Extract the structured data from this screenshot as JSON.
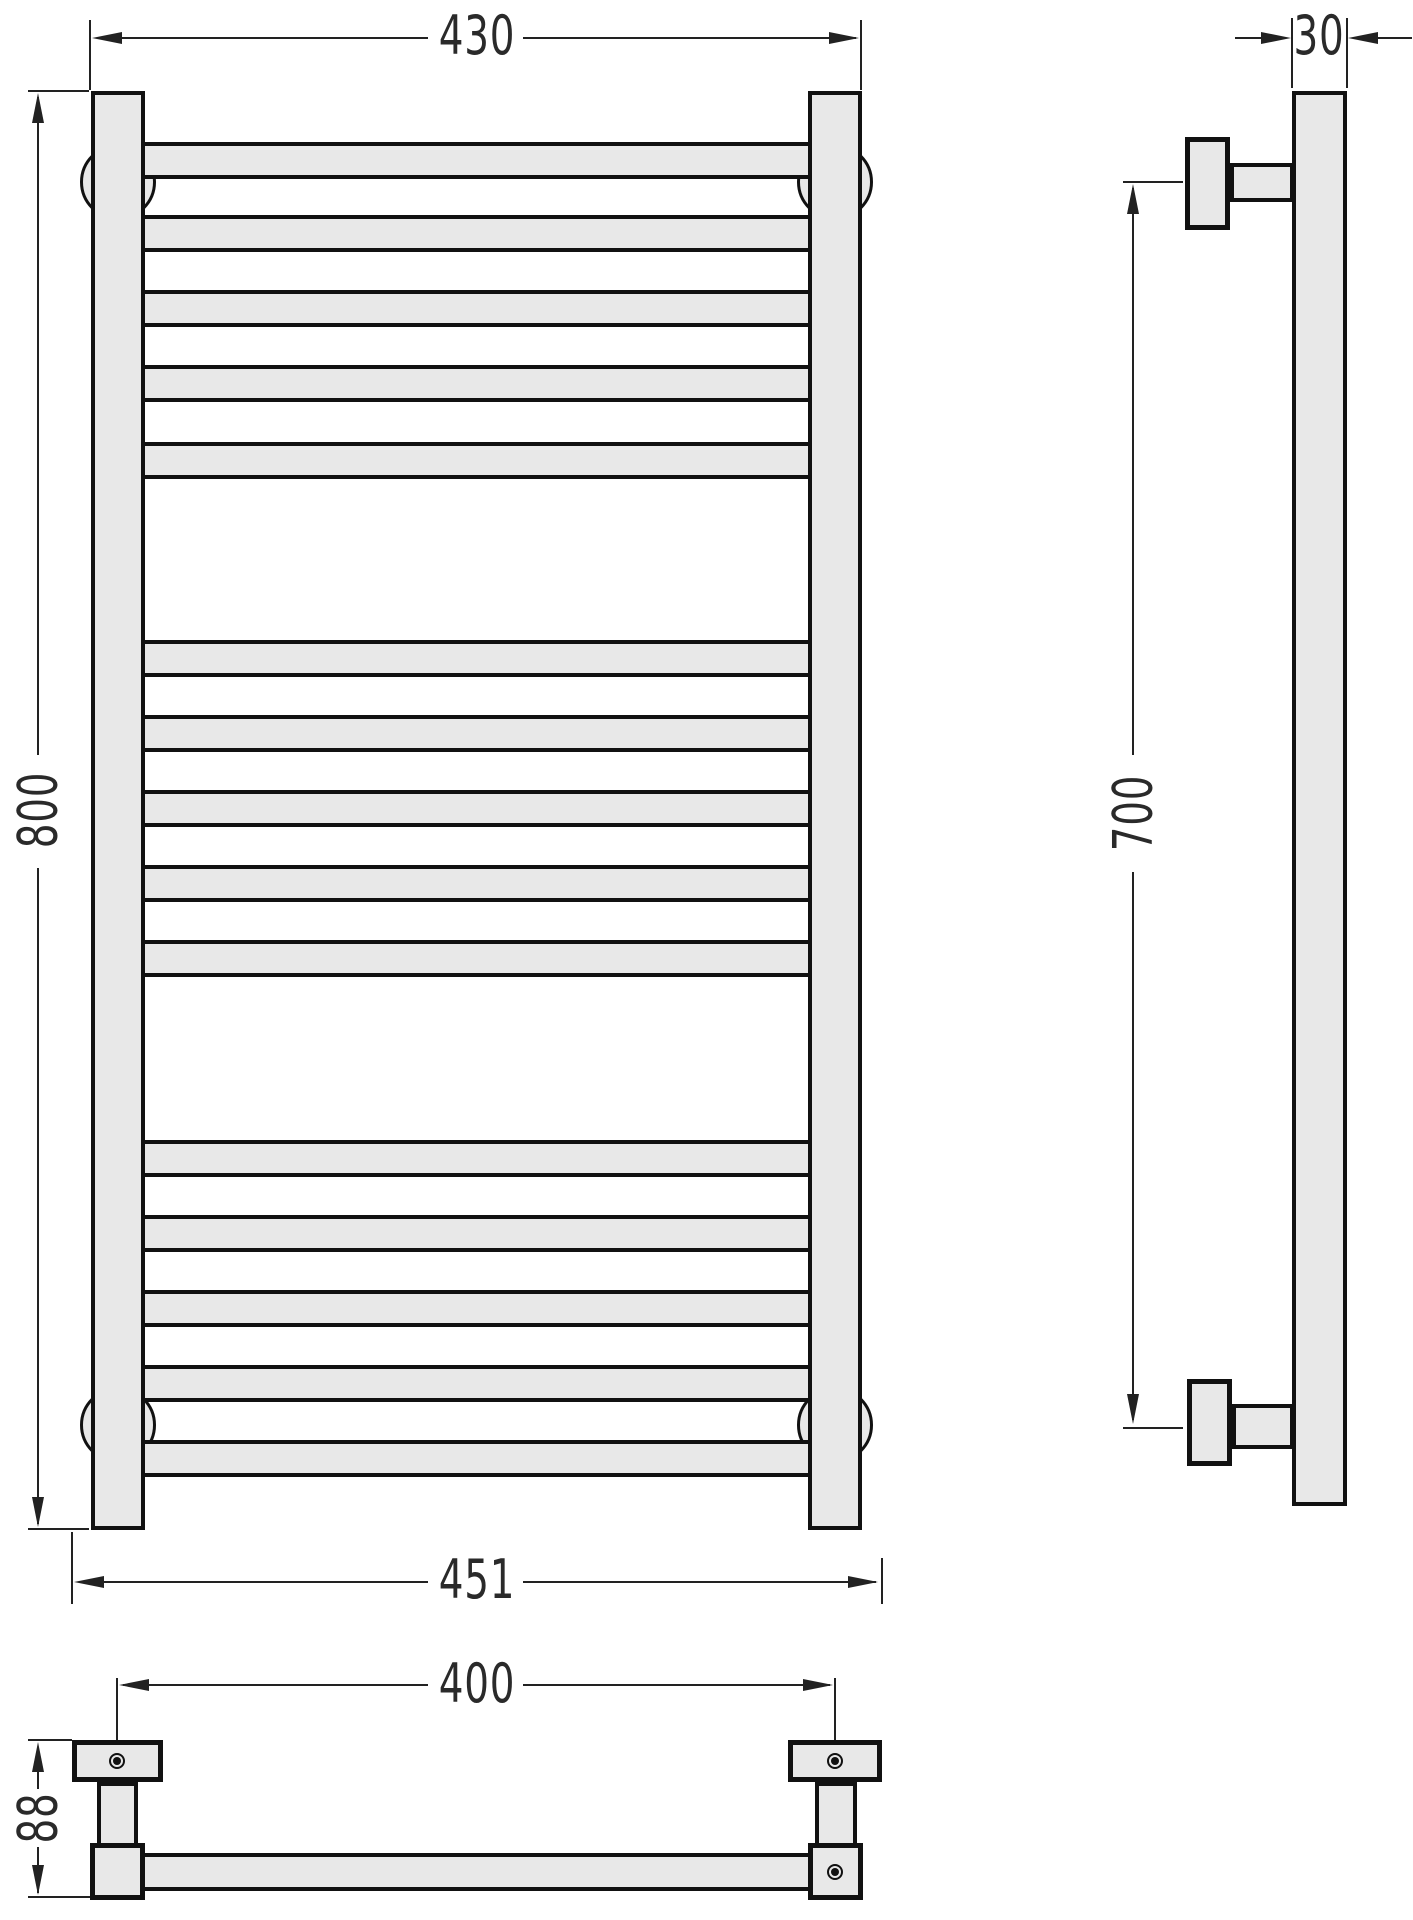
{
  "drawing": {
    "type": "technical-drawing",
    "subject": "ladder towel rail, three orthographic views",
    "colors": {
      "part_fill": "#e8e8e8",
      "object_line": "#111111",
      "dimension_line": "#222222"
    }
  },
  "dimensions": {
    "front_width": "430",
    "front_height": "800",
    "front_overall_width": "451",
    "side_depth": "30",
    "side_bracket_span": "700",
    "bottom_hole_span": "400",
    "bottom_depth": "88"
  }
}
